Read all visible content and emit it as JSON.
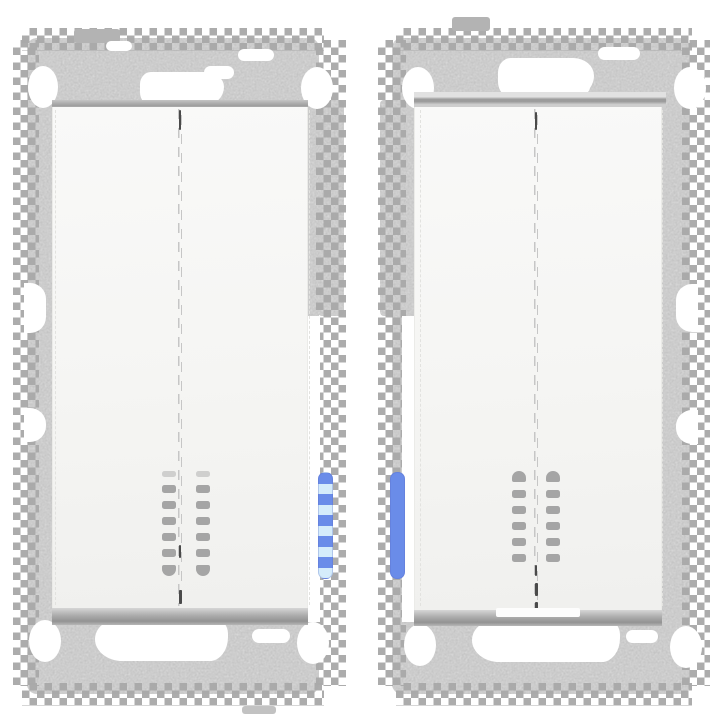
{
  "title": "Two flush-mount double rocker switch inserts with blue LED indicators, front views",
  "colors": {
    "background": "#ffffff",
    "plate-base": "#d8d8d8",
    "grain": "#8c8c8c",
    "teeth": "#a9a9a9",
    "rocker": "#f6f6f4",
    "bevel-dark": "#9d9d9d",
    "slot": "#a5a5a5",
    "seam": "#c6c6c6",
    "seam-dark": "#4a4a4a",
    "led": "#6a8ce9",
    "led-bright": "#d5ecfb",
    "cutout": "#ffffff"
  },
  "units": [
    {
      "name": "left switch unit",
      "led": {
        "position": "right-edge",
        "style": "banded",
        "bright_segments": 5
      },
      "indicator": {
        "columns": 2,
        "rows": 7
      }
    },
    {
      "name": "right switch unit",
      "led": {
        "position": "left-edge",
        "style": "solid",
        "bright_segments": 0
      },
      "indicator": {
        "columns": 2,
        "rows": 6
      }
    }
  ]
}
